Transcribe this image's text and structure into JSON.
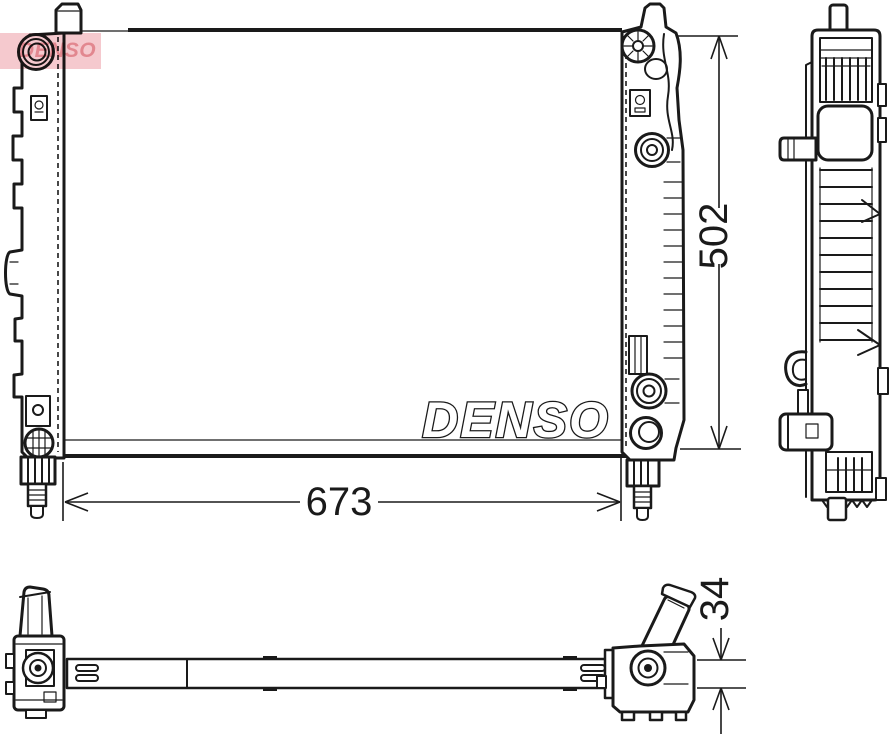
{
  "brand": {
    "core_logo_text": "DENSO",
    "watermark_text": "DENSO"
  },
  "dimensions": {
    "width_label": "673",
    "height_label": "502",
    "depth_label": "34"
  },
  "colors": {
    "line": "#1a1a1a",
    "core_pattern": "#909090",
    "watermark_background": "#f5c9ce",
    "watermark_text": "#e2878f",
    "background": "#ffffff"
  },
  "views": {
    "front": "radiator-front-view",
    "side": "radiator-side-view",
    "bottom": "radiator-bottom-view"
  }
}
